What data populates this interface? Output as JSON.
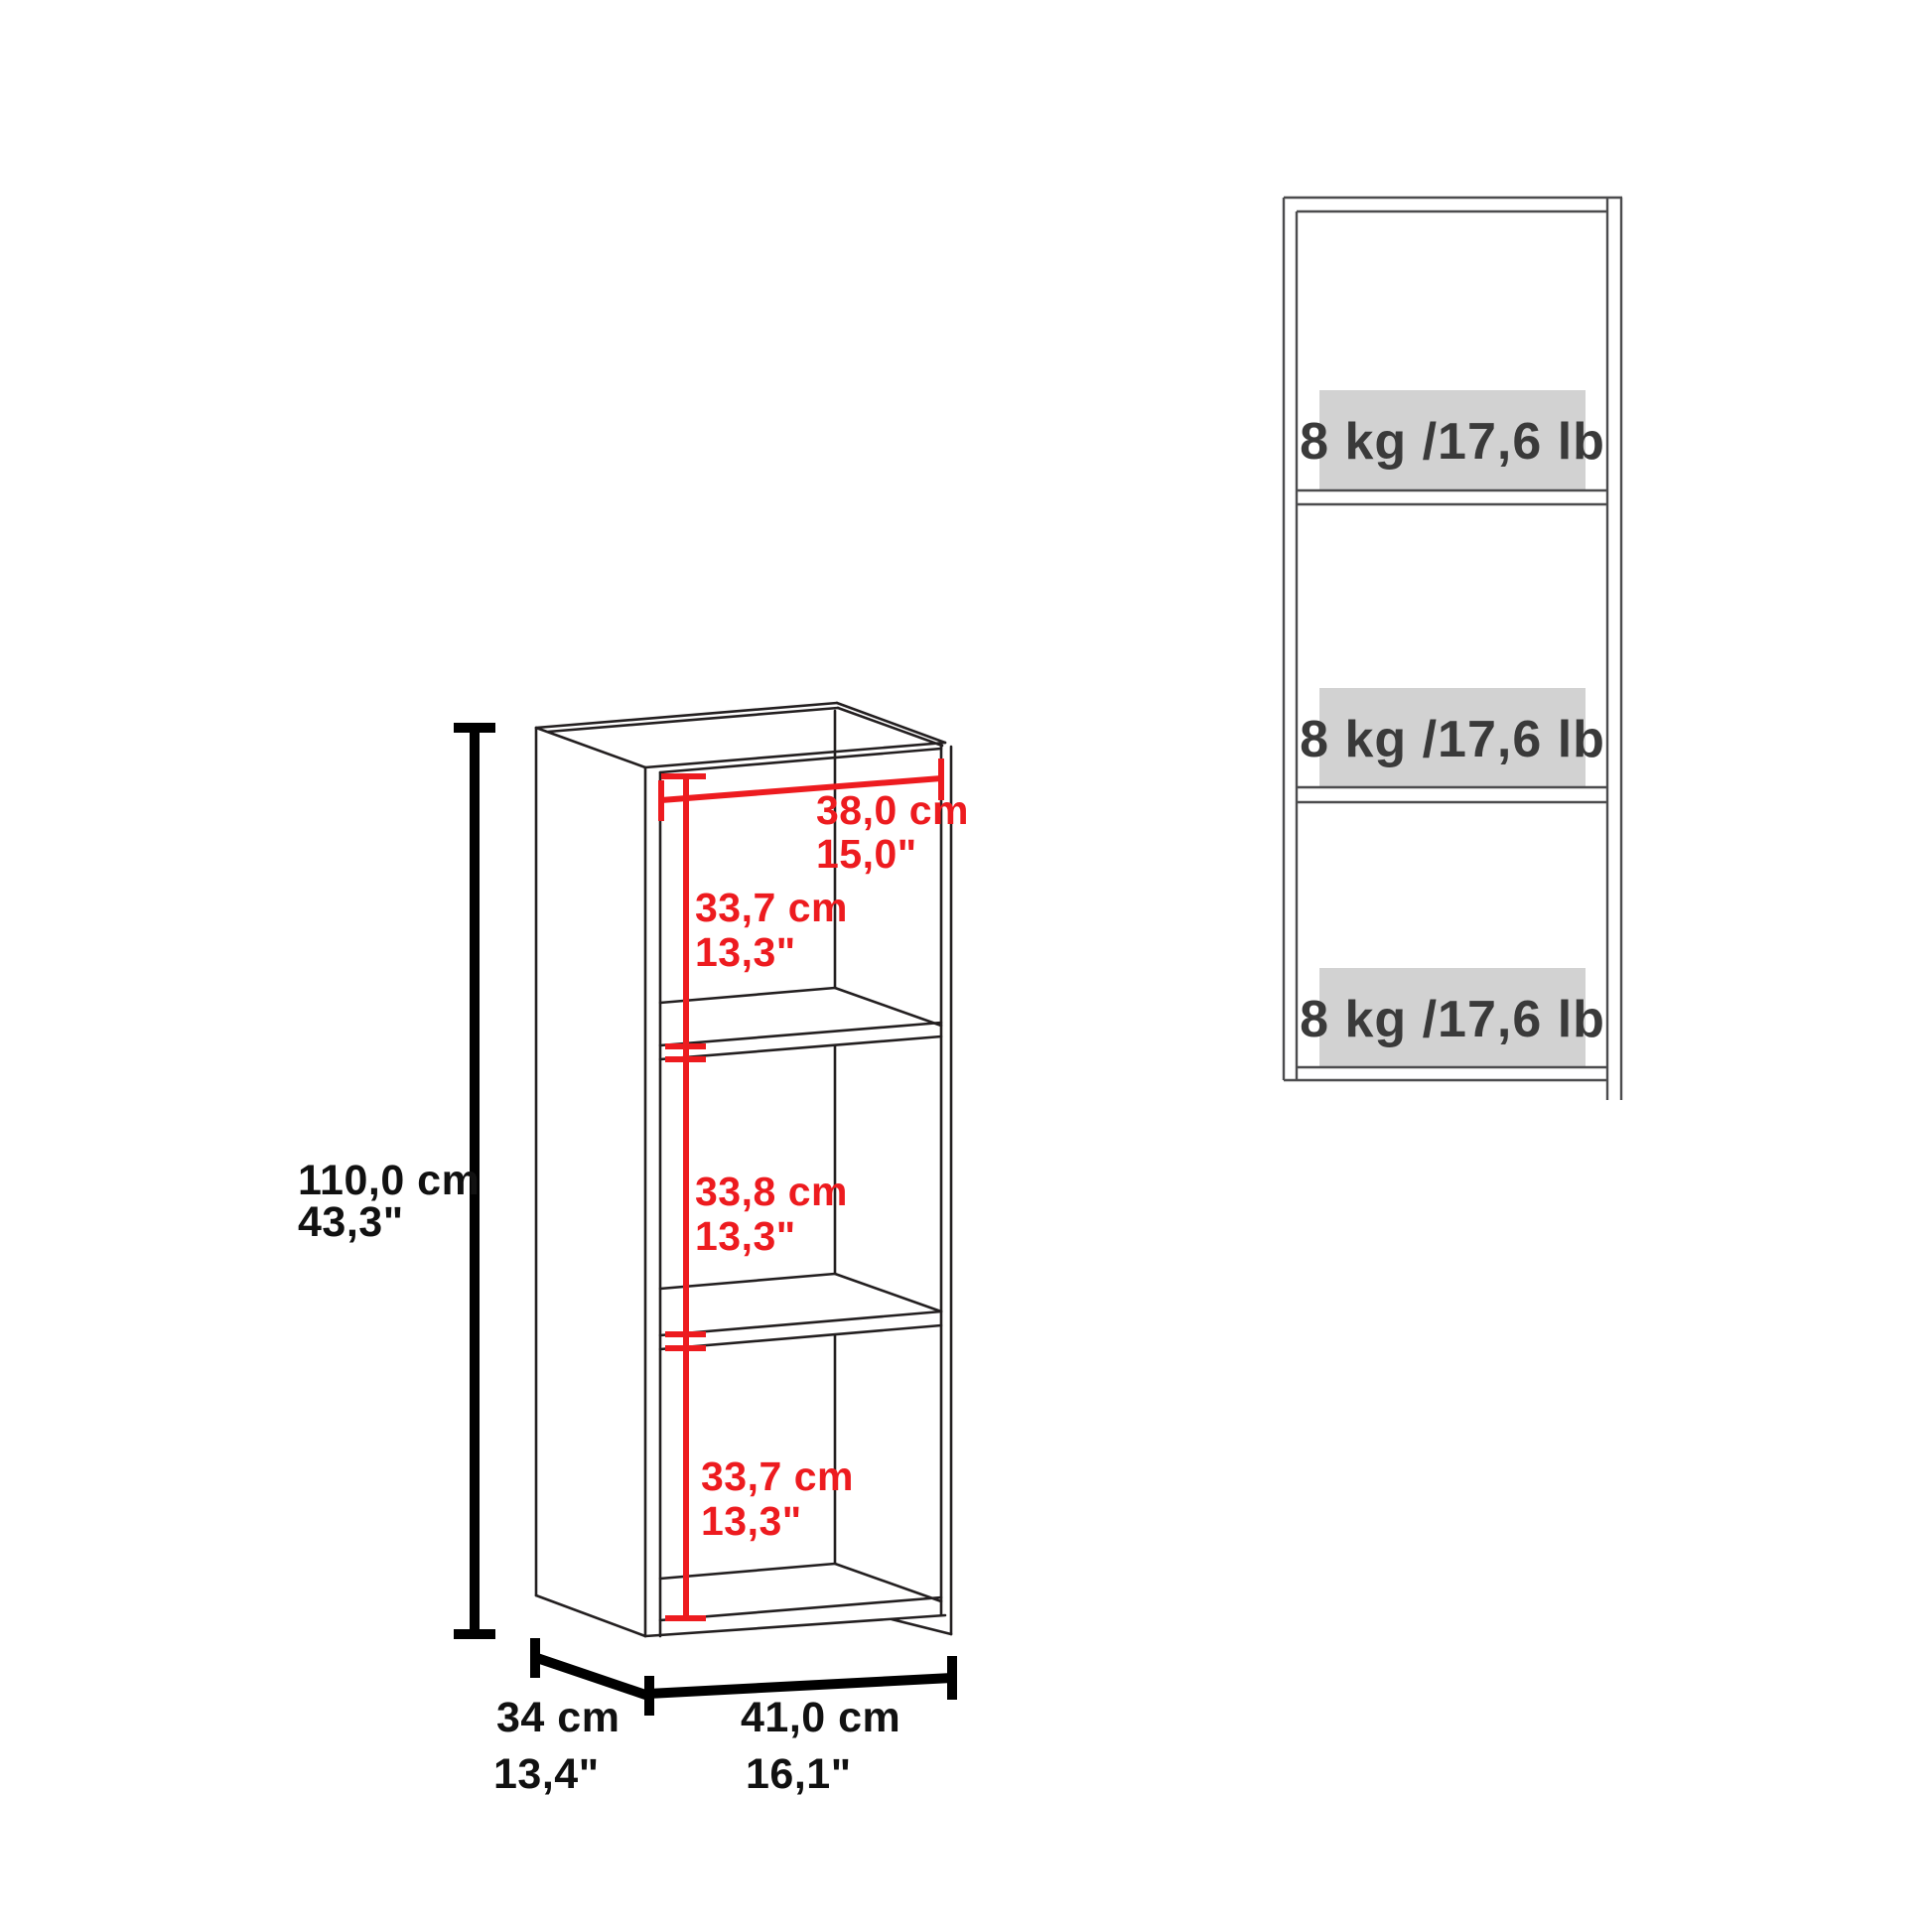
{
  "diagram": {
    "type": "furniture-dimension-diagram",
    "product": "3-shelf bookcase",
    "colors": {
      "dimension_red": "#ed1b1f",
      "dimension_black": "#000000",
      "outline_dark": "#231f20",
      "front_view_gray": "#4c4c4e",
      "capacity_box_gray": "#d2d2d2",
      "capacity_text_gray": "#3a3a3a",
      "background": "#ffffff"
    }
  },
  "isometric_view": {
    "overall_height_cm": "110,0 cm",
    "overall_height_in": "43,3\"",
    "inner_width_cm": "38,0 cm",
    "inner_width_in": "15,0\"",
    "top_compartment_height_cm": "33,7 cm",
    "top_compartment_height_in": "13,3\"",
    "middle_compartment_height_cm": "33,8 cm",
    "middle_compartment_height_in": "13,3\"",
    "bottom_compartment_height_cm": "33,7 cm",
    "bottom_compartment_height_in": "13,3\"",
    "depth_cm": "34 cm",
    "depth_in": "13,4\"",
    "overall_width_cm": "41,0 cm",
    "overall_width_in": "16,1\""
  },
  "front_view": {
    "shelf_top_capacity": "8 kg /17,6 lb",
    "shelf_middle_capacity": "8 kg /17,6 lb",
    "shelf_bottom_capacity": "8 kg /17,6 lb"
  }
}
